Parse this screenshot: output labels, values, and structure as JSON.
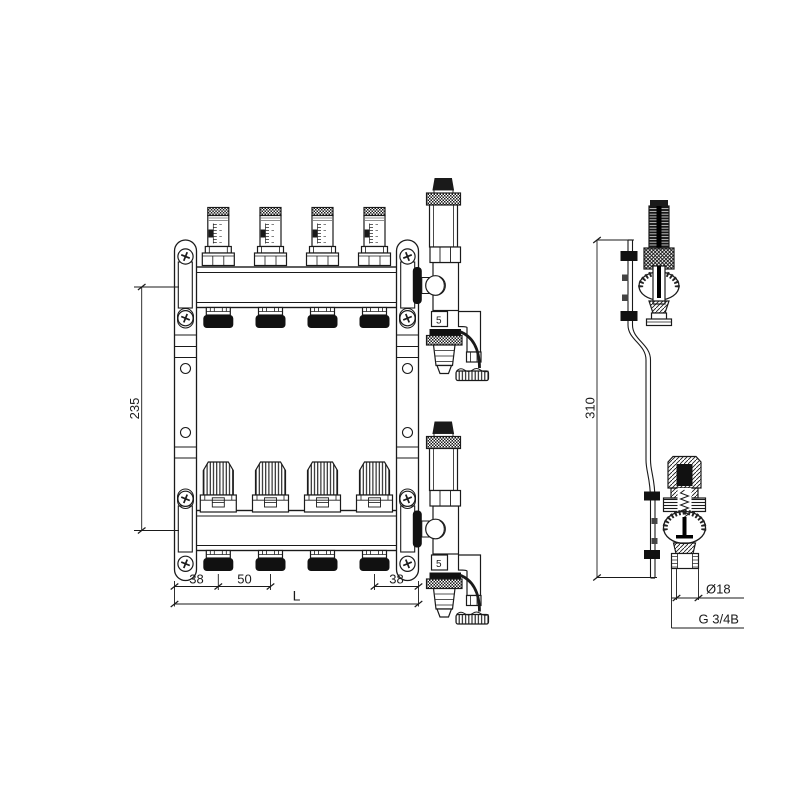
{
  "drawing": {
    "title": "manifold-technical-drawing",
    "line_color": "#1a1a1a",
    "background": "#ffffff",
    "front_view": {
      "dim_center_distance": "235",
      "dim_left_offset": "38",
      "dim_port_pitch": "50",
      "dim_right_offset": "38",
      "dim_total_length": "L",
      "valve_body_marking": "5",
      "flow_meter_count": 4,
      "actuator_count": 4
    },
    "side_view": {
      "dim_bracket_height": "310",
      "dim_pipe_diameter": "Ø18",
      "dim_thread": "G 3/4B"
    }
  }
}
